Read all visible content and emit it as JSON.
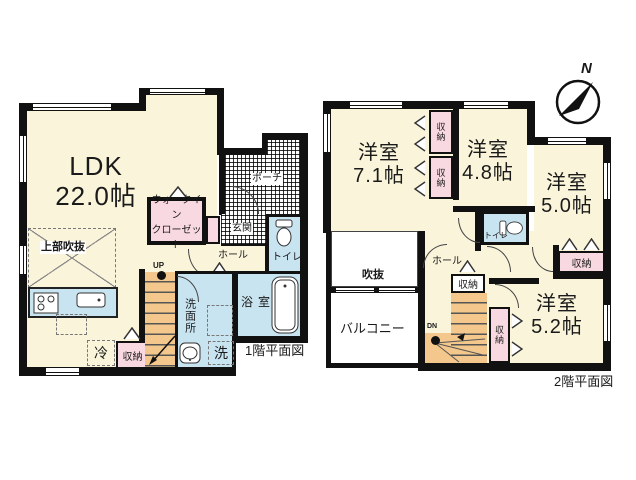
{
  "palette": {
    "wall": "#111111",
    "room_cream": "#FAF5DA",
    "water_blue": "#C9E4F1",
    "closet_pink": "#F9D9E1",
    "stairs_orange": "#F4C78C"
  },
  "compass": {
    "north": "N"
  },
  "floor1": {
    "caption": "1階平面図",
    "ldk": {
      "name": "LDK",
      "size": "22.0帖"
    },
    "void_above": "上部吹抜",
    "wic": {
      "line1": "ウォークイン",
      "line2": "クローゼット"
    },
    "hall": "ホール",
    "genkan": "玄関",
    "porch": "ポーチ",
    "toilet": "トイレ",
    "washroom": "洗面所",
    "bath": "浴室",
    "laundry": "洗",
    "fridge": "冷",
    "storage_kitchen": "収納",
    "storage_hall": "収納",
    "up": "UP"
  },
  "floor2": {
    "caption": "2階平面図",
    "room_71": {
      "name": "洋室",
      "size": "7.1帖"
    },
    "room_48": {
      "name": "洋室",
      "size": "4.8帖"
    },
    "room_50": {
      "name": "洋室",
      "size": "5.0帖"
    },
    "room_52": {
      "name": "洋室",
      "size": "5.2帖"
    },
    "void": "吹抜",
    "balcony": "バルコニー",
    "hall": "ホール",
    "toilet": "トイレ",
    "storage_nw_top": "収納",
    "storage_nw_bottom": "収納",
    "storage_hall": "収納",
    "storage_mid": "収納",
    "storage_east": "収納",
    "dn": "DN"
  }
}
